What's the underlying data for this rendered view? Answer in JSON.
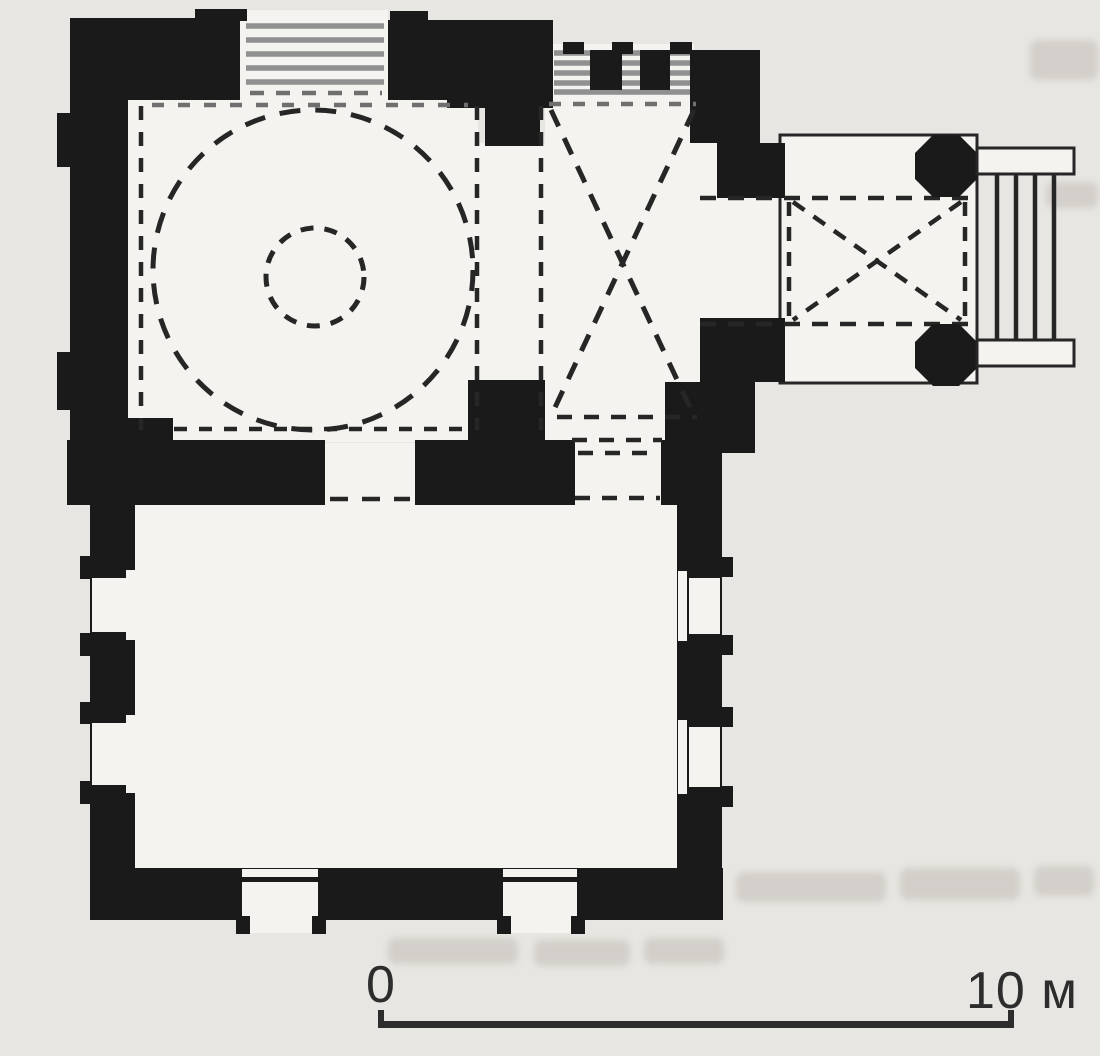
{
  "figure": {
    "kind": "scanned architectural floor plan",
    "scale_bar": {
      "start_label": "0",
      "end_label": "10 м"
    }
  },
  "colors": {
    "paper": "#e8e6e2",
    "interior": "#f5f3ef",
    "wall": "#1a1a1a",
    "line": "#262626",
    "line-soft": "#6f6f6f",
    "gray-step": "#909090",
    "text": "#2d2d2d",
    "bleed": "#aba49a"
  }
}
